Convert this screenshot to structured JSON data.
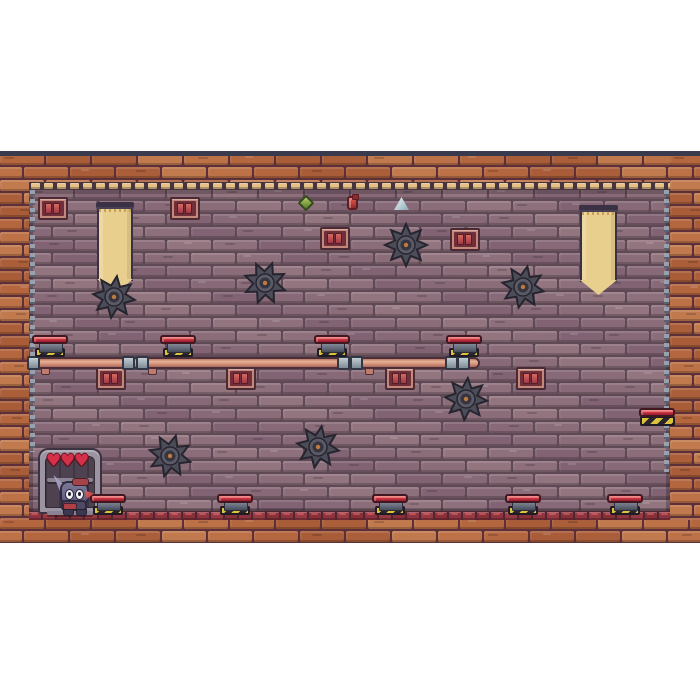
{
  "scene": {
    "description": "pixel-art platformer level: brick-walled dungeon room with saw blades, pipes, piston traps, banners and a bunny player",
    "hud": {
      "hearts_count": 3
    }
  },
  "game": {
    "area": {
      "x": 0,
      "y": 151,
      "w": 700,
      "h": 392
    },
    "colors": {
      "page_bg": "#ffffff",
      "frame_line": "#3a3a4e",
      "border_mortar": "#5c2f39",
      "border_bricks": [
        "#b4663f",
        "#aa5f3a",
        "#bd7147",
        "#a85c38",
        "#c07a4e"
      ],
      "wall_mortar": "#5e4954",
      "wall_planks": [
        "#8d707c",
        "#876977",
        "#93757f",
        "#816374",
        "#8a6d79"
      ],
      "trim_cream_bg": "#46353f",
      "trim_cream": "#e6c088",
      "trim_red_bg": "#512631",
      "trim_red": [
        "#8e3440",
        "#963a44",
        "#873039"
      ],
      "banner": "#e9cf8e",
      "banner_bar": "#3a3145",
      "saw": "#4d4d5a",
      "saw_dark": "#26252f",
      "saw_eye": "#c07a3e",
      "pipe": "#d28f7a",
      "coupler": "#a9b6bc",
      "cap_red": "#c22c3c",
      "piston_base": "#636a77",
      "hazard_yellow": "#ddc23c",
      "hazard_black": "#29252f",
      "heart": "#d5304a",
      "window_frame": "#c4887b",
      "window_inner": "#6e2f3a",
      "chain": "#98a2af",
      "alcove_frame": "#9c94a3",
      "alcove_inner": "#4e4150",
      "player_body": "#6d6887"
    },
    "layout": {
      "frame_line": {
        "x": 0,
        "y": 0,
        "w": 700,
        "h": 5
      },
      "border_top": {
        "x": 0,
        "y": 5,
        "w": 700,
        "h": 26
      },
      "border_left": {
        "x": 0,
        "y": 5,
        "w": 29,
        "h": 387
      },
      "border_right": {
        "x": 670,
        "y": 5,
        "w": 30,
        "h": 387
      },
      "border_bottom": {
        "x": 0,
        "y": 369,
        "w": 700,
        "h": 23
      },
      "trim_cream": {
        "x": 29,
        "y": 31,
        "w": 641,
        "h": 8
      },
      "interior": {
        "x": 29,
        "y": 39,
        "w": 641,
        "h": 321
      },
      "trim_red": {
        "x": 29,
        "y": 360,
        "w": 641,
        "h": 9
      }
    },
    "chains": [
      {
        "x": 30,
        "top": 39,
        "h": 262
      },
      {
        "x": 664,
        "top": 39,
        "h": 282
      }
    ],
    "windows": [
      {
        "x": 38,
        "y": 46
      },
      {
        "x": 170,
        "y": 46
      },
      {
        "x": 320,
        "y": 76
      },
      {
        "x": 450,
        "y": 77
      },
      {
        "x": 96,
        "y": 216
      },
      {
        "x": 226,
        "y": 216
      },
      {
        "x": 385,
        "y": 216
      },
      {
        "x": 516,
        "y": 216
      }
    ],
    "window_size": {
      "w": 26,
      "h": 19
    },
    "banners": [
      {
        "x": 97,
        "y": 51,
        "w": 36,
        "h": 92
      },
      {
        "x": 580,
        "y": 54,
        "w": 37,
        "h": 90
      }
    ],
    "potions": [
      {
        "type": "green-gem",
        "x": 300,
        "y": 46,
        "w": 12,
        "h": 12
      },
      {
        "type": "red-flask",
        "x": 347,
        "y": 45,
        "w": 11,
        "h": 14
      },
      {
        "type": "blue-crystal",
        "x": 394,
        "y": 46,
        "w": 15,
        "h": 13
      }
    ],
    "saws": [
      {
        "x": 114,
        "y": 146,
        "rot": 8
      },
      {
        "x": 265,
        "y": 132,
        "rot": 20
      },
      {
        "x": 406,
        "y": 94,
        "rot": 0
      },
      {
        "x": 523,
        "y": 136,
        "rot": 12
      },
      {
        "x": 466,
        "y": 248,
        "rot": 5
      },
      {
        "x": 170,
        "y": 305,
        "rot": 16
      },
      {
        "x": 318,
        "y": 296,
        "rot": 10
      }
    ],
    "saw_radius": 21,
    "pipe": {
      "x": 27,
      "y": 206,
      "len": 453,
      "h": 12,
      "couplers": [
        27,
        122,
        136,
        337,
        350,
        445,
        457
      ],
      "coupler_w": 13,
      "coupler_h": 14,
      "tabs": [
        41,
        148,
        365
      ]
    },
    "pipe_pistons": {
      "centers": [
        50,
        178,
        332,
        464
      ],
      "cap_y": 184,
      "base_y": 192,
      "hazard_y": 197
    },
    "floor_pistons": {
      "centers": [
        108,
        235,
        390,
        523,
        625
      ],
      "cap_y": 343,
      "base_y": 350,
      "hazard_y": 355
    },
    "piston_dims": {
      "cap_w": 36,
      "cap_h": 9,
      "base_w": 22,
      "base_h": 8,
      "hazard_w": 30,
      "hazard_h": 9
    },
    "wall_platform": {
      "x": 639,
      "y": 257,
      "w": 36,
      "cap_h": 9,
      "hazard_h": 10
    },
    "alcove": {
      "x": 38,
      "y": 297,
      "w": 64,
      "h": 66,
      "shelf1": 22,
      "shelf2": 55
    },
    "hearts": {
      "count": 3,
      "x": 46,
      "y": 303,
      "gap": 14
    },
    "player": {
      "x": 51,
      "y": 324
    }
  }
}
